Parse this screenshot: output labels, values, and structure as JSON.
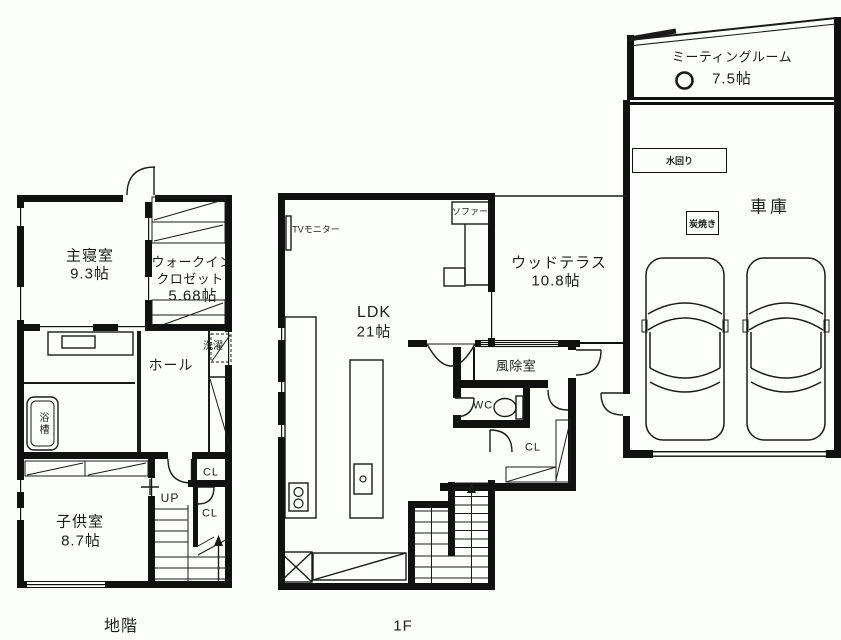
{
  "page": {
    "background": "#fcfffc",
    "ink": "#111111"
  },
  "basement": {
    "floor_label": "地階",
    "master_bedroom_name": "主寝室",
    "master_bedroom_size": "9.3帖",
    "walkin_closet_line1": "ウォークイン",
    "walkin_closet_line2": "クロゼット",
    "walkin_closet_size": "5.68帖",
    "hall": "ホール",
    "laundry": "洗濯",
    "bathtub": "浴槽",
    "kids_room_name": "子供室",
    "kids_room_size": "8.7帖",
    "up": "UP",
    "closet_upper": "CL",
    "closet_lower": "CL"
  },
  "first_floor": {
    "floor_label": "1F",
    "ldk_name": "LDK",
    "ldk_size": "21帖",
    "tv_monitor": "TVモニター",
    "sofa": "ソファー",
    "terrace_name": "ウッドテラス",
    "terrace_size": "10.8帖",
    "windbreak_room": "風除室",
    "wc": "WC",
    "closet": "CL",
    "meeting_room_name": "ミーティングルーム",
    "meeting_room_size": "7.5帖",
    "water_area": "水回り",
    "charcoal_grill": "炭焼き",
    "garage": "車庫"
  }
}
